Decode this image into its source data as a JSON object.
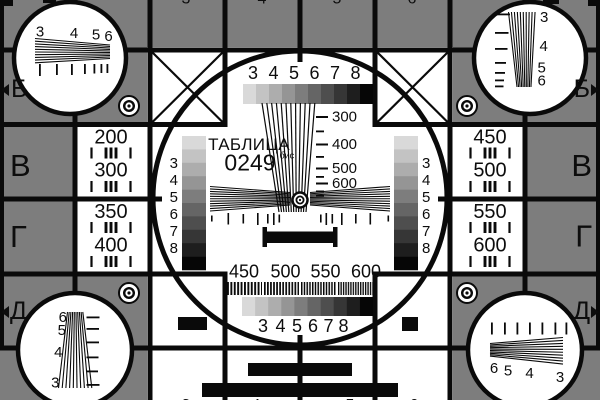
{
  "card": {
    "title": "ТАБЛИЦА",
    "code": "0249",
    "code_suffix": "бис"
  },
  "colors": {
    "background": "#7d7d7d",
    "ink": "#0a0a0a",
    "white": "#ffffff",
    "grayscale_palette": [
      "#d9d9d9",
      "#c3c3c3",
      "#adadad",
      "#959595",
      "#7d7d7d",
      "#656565",
      "#4e4e4e",
      "#363636",
      "#1e1e1e",
      "#060606"
    ]
  },
  "center": {
    "top_scale_digits": [
      "3",
      "4",
      "5",
      "6",
      "7",
      "8"
    ],
    "bottom_scale_digits": [
      "3",
      "4",
      "5",
      "6",
      "7",
      "8"
    ],
    "left_strip_digits": [
      "3",
      "4",
      "5",
      "6",
      "7",
      "8"
    ],
    "right_strip_digits": [
      "3",
      "4",
      "5",
      "6",
      "7",
      "8"
    ],
    "vertical_wedge_labels": [
      "300",
      "400",
      "500",
      "600"
    ],
    "frequency_labels": [
      "450",
      "500",
      "550",
      "600"
    ]
  },
  "side_panels": {
    "left_upper": [
      "200",
      "300"
    ],
    "left_lower": [
      "350",
      "400"
    ],
    "right_upper": [
      "450",
      "500"
    ],
    "right_lower": [
      "550",
      "600"
    ]
  },
  "row_markers": {
    "left": [
      "Б",
      "В",
      "Г",
      "Д"
    ],
    "right": [
      "Б",
      "В",
      "Г",
      "Д"
    ]
  },
  "corner_circles": {
    "top_left_labels": [
      "3",
      "4",
      "5",
      "6"
    ],
    "top_right_labels": [
      "3",
      "4",
      "5",
      "6"
    ],
    "bottom_left_labels": [
      "6",
      "5",
      "4",
      "3"
    ],
    "bottom_right_labels": [
      "6",
      "5",
      "4",
      "3"
    ]
  },
  "clipped_digits": {
    "top": [
      "3",
      "4",
      "5",
      "6"
    ],
    "bottom": [
      "3",
      "4",
      "5",
      "6"
    ]
  }
}
